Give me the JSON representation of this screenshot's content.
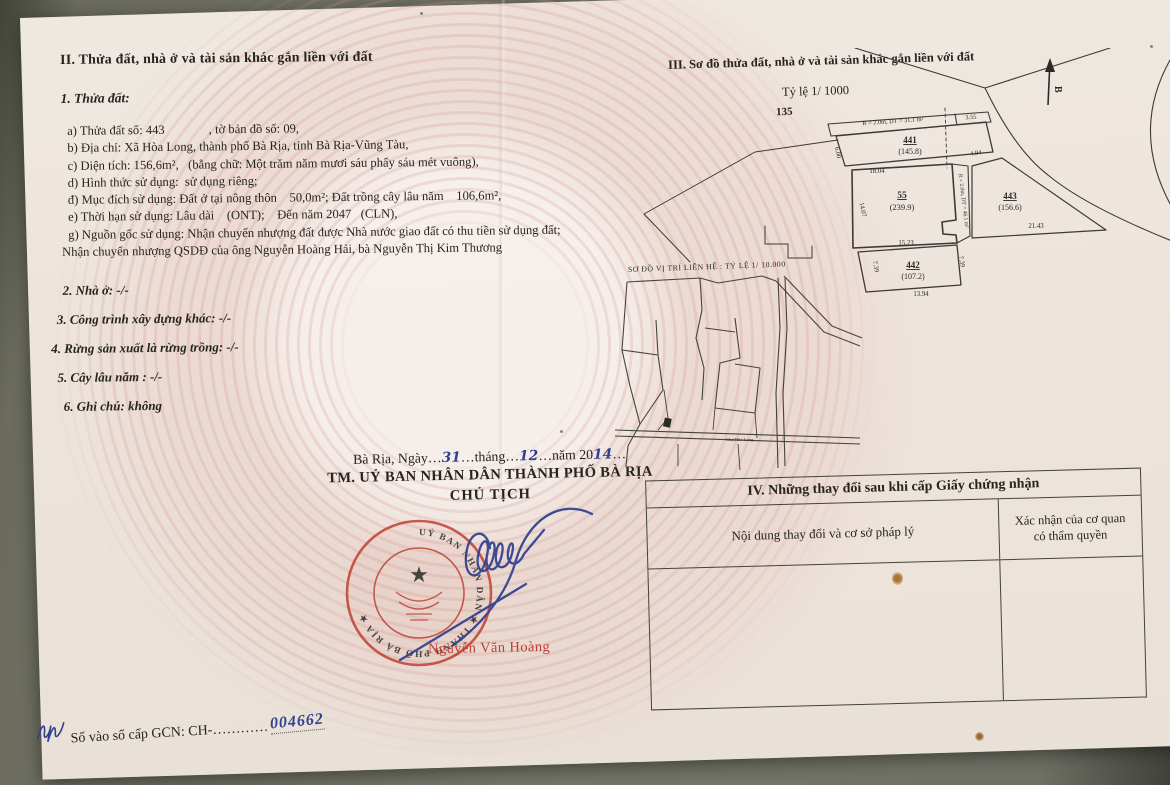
{
  "colors": {
    "paper": "#ece4dc",
    "ink": "#26241f",
    "stamp_red": "#bf3f33",
    "pen_blue": "#31418f",
    "background": "#6e7064"
  },
  "section2": {
    "heading": "II. Thửa đất, nhà ở và tài sản khác gắn liền với đất",
    "sub": "1. Thửa đất:",
    "lines": [
      "  a) Thửa đất số: 443              , tờ bản đồ số: 09,",
      "  b) Địa chỉ: Xã Hòa Long, thành phố Bà Rịa, tỉnh Bà Rịa-Vũng Tàu,",
      "  c) Diện tích: 156,6m²,   (bằng chữ: Một trăm năm mươi sáu phẩy sáu mét vuông),",
      "  d) Hình thức sử dụng:  sử dụng riêng;",
      "  đ) Mục đích sử dụng: Đất ở tại nông thôn    50,0m²; Đất trồng cây lâu năm    106,6m²,",
      "  e) Thời hạn sử dụng: Lâu dài    (ONT);    Đến năm 2047   (CLN),",
      "  g) Nguồn gốc sử dụng: Nhận chuyển nhượng đất được Nhà nước giao đất có thu tiền sử dụng đất;",
      "Nhận chuyển nhượng QSDĐ của ông Nguyễn Hoàng Hải, bà Nguyễn Thị Kim Thương"
    ],
    "extras": [
      "2. Nhà ở: -/-",
      "3. Công trình xây dựng khác: -/-",
      "4. Rừng sản xuất là rừng trồng: -/-",
      "5. Cây lâu năm : -/-",
      "6. Ghi chú: không"
    ]
  },
  "section3": {
    "heading": "III. Sơ đồ thửa đất, nhà ở và tài sản khác gắn liền với đất",
    "scale": "Tỷ lệ 1/ 1000",
    "sheet": "135",
    "north_label": "B",
    "strip_top": "R = 2.0m, DT = 31.1 m²",
    "strip_right": "R = 2.0m, DT = 46.1 m²",
    "plots": {
      "p441": {
        "id": "441",
        "area": "(145.8)"
      },
      "p55": {
        "id": "55",
        "area": "(239.9)"
      },
      "p443": {
        "id": "443",
        "area": "(156.6)"
      },
      "p442": {
        "id": "442",
        "area": "(107.2)"
      }
    },
    "dims": {
      "d355": "3.55",
      "d600": "6.00",
      "d494": "4.94",
      "d1804": "18.04",
      "d1407": "14.07",
      "d1523": "15.23",
      "d2143": "21.43",
      "d739a": "7.39",
      "d739b": "7.39",
      "d1394": "13.94"
    }
  },
  "map": {
    "caption": "SƠ ĐỒ VỊ TRÍ LIÊN HỆ : TỶ LỆ 1/ 10.000",
    "road_label": "Chợ Hòa Long"
  },
  "sign": {
    "date_p1": "Bà Rịa, Ngày…",
    "date_day": "31",
    "date_p2": "…tháng…",
    "date_month": "12",
    "date_p3": "…năm 20",
    "date_year": "14",
    "date_p4": "…",
    "committee": "TM. UỶ BAN NHÂN DÂN THÀNH PHỐ BÀ RỊA",
    "chairman": "CHỦ TỊCH",
    "stamp_text": "UỶ BAN NHÂN DÂN ★ THÀNH PHỐ BÀ RỊA ★ ",
    "stamp_star": "★",
    "signer_name": "Nguyễn Văn Hoàng"
  },
  "section4": {
    "title": "IV. Những thay đổi sau khi cấp Giấy chứng nhận",
    "col1": "Nội dung thay đổi và cơ sở pháp lý",
    "col2": "Xác nhận của cơ quan có thẩm quyền"
  },
  "footer": {
    "label": "Số vào sổ cấp GCN: CH-",
    "dots": "…………",
    "number": "004662"
  }
}
